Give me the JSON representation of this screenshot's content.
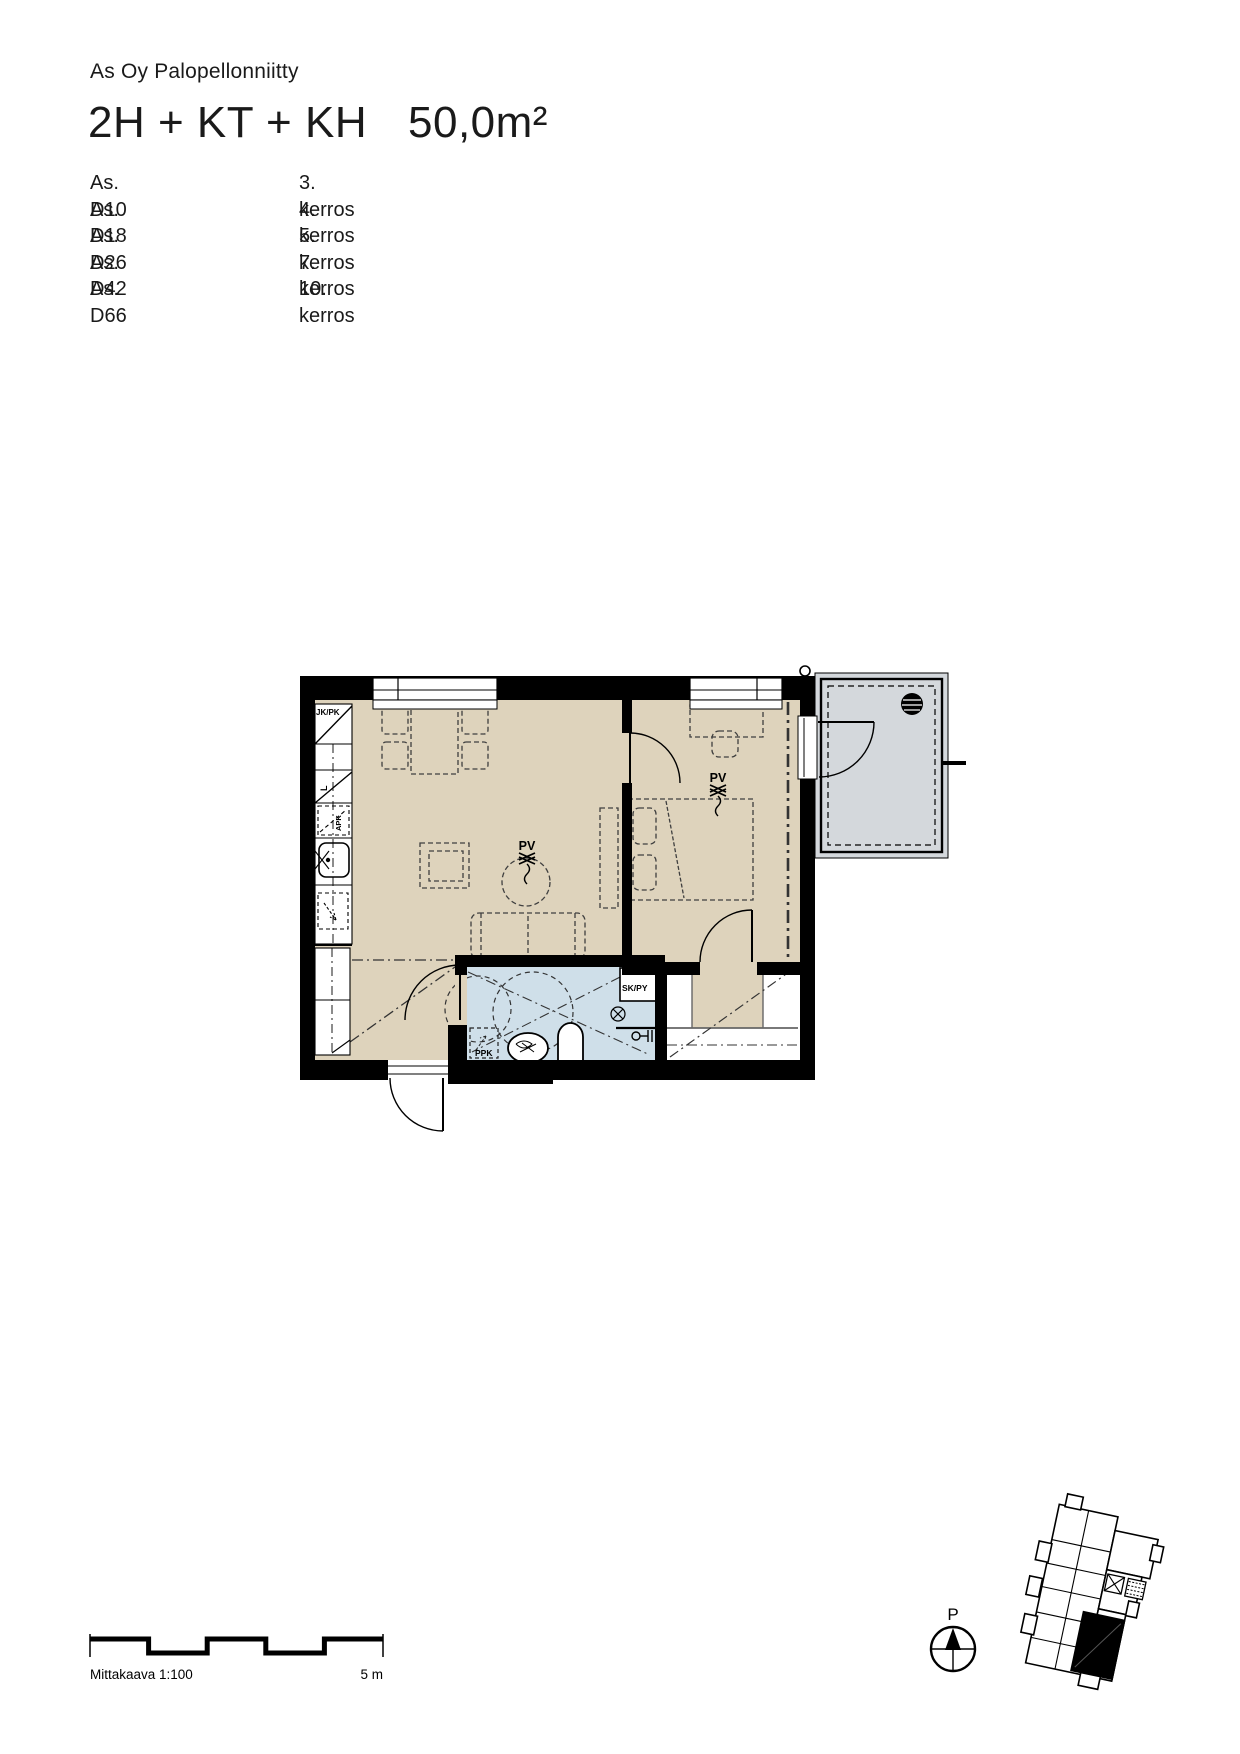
{
  "header": {
    "company": "As Oy Palopellonniitty",
    "title": "2H + KT + KH",
    "area": "50,0m²"
  },
  "apartments": [
    {
      "unit": "As. D10",
      "floor": "3. kerros"
    },
    {
      "unit": "As. D18",
      "floor": "4. kerros"
    },
    {
      "unit": "As. D26",
      "floor": "5. kerros"
    },
    {
      "unit": "As. D42",
      "floor": "7. kerros"
    },
    {
      "unit": "As. D66",
      "floor": "10. kerros"
    }
  ],
  "plan": {
    "labels": {
      "fridge": "JK/PK",
      "stove": "L",
      "dishwasher": "APK",
      "washer": "PPK",
      "closet": "SK/PY",
      "pv": "PV"
    },
    "colors": {
      "floor": "#ded3bc",
      "wet": "#cfdfe9",
      "balcony": "#d4d8dc",
      "wall": "#000000"
    }
  },
  "scalebar": {
    "label": "Mittakaava 1:100",
    "max_label": "5 m"
  },
  "compass": {
    "label": "P"
  }
}
